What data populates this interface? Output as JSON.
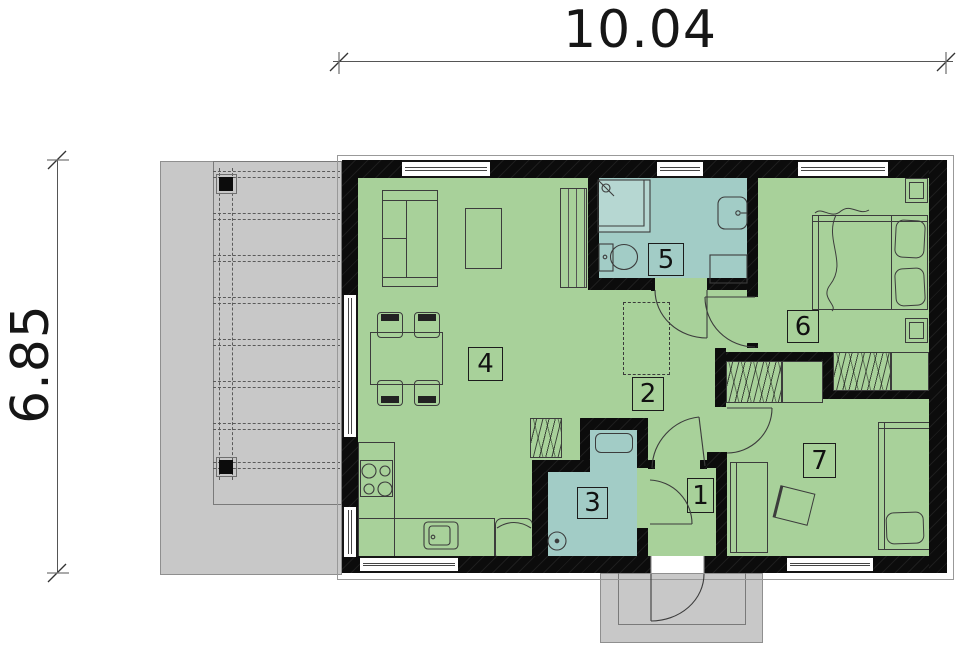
{
  "drawing": {
    "type": "house-floor-plan",
    "dimensions": {
      "width_m": "10.04",
      "depth_m": "6.85"
    },
    "rooms": [
      {
        "label": "1",
        "fill": "#a8d19a"
      },
      {
        "label": "2",
        "fill": "#a8d19a"
      },
      {
        "label": "3",
        "fill": "#a2ccc6"
      },
      {
        "label": "4",
        "fill": "#a8d19a"
      },
      {
        "label": "5",
        "fill": "#a2ccc6"
      },
      {
        "label": "6",
        "fill": "#a8d19a"
      },
      {
        "label": "7",
        "fill": "#a8d19a"
      }
    ],
    "palette": {
      "room_green": "#a8d19a",
      "room_blue": "#a2ccc6",
      "wall": "#0c0c0c",
      "terrace_gray": "#c8c8c8",
      "line_gray": "#555555"
    }
  }
}
